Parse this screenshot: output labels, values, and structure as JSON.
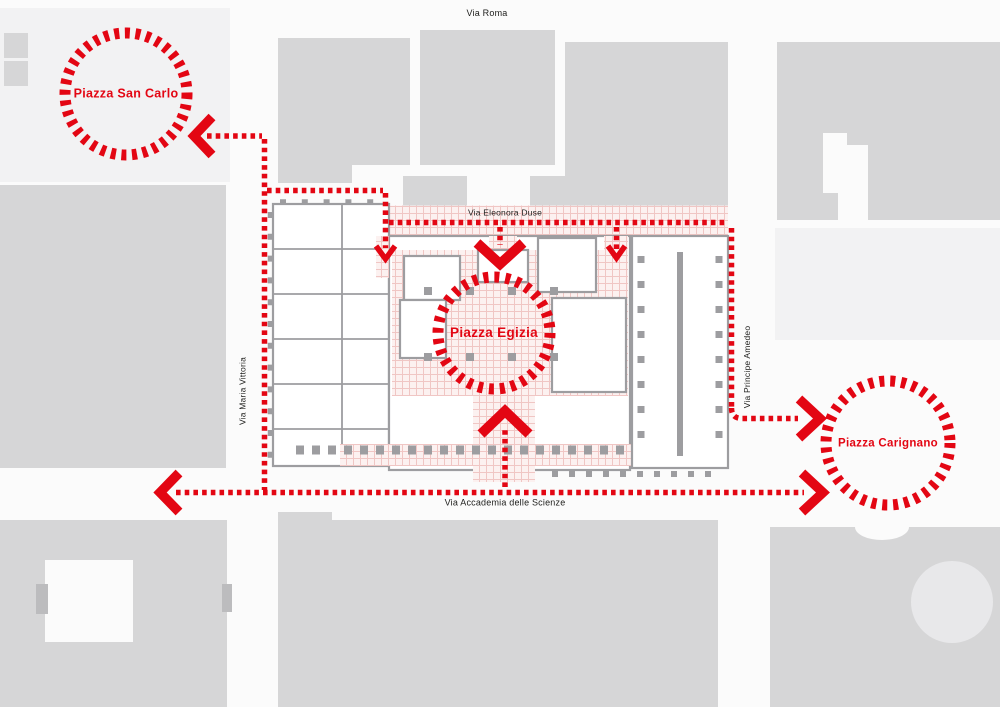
{
  "map": {
    "streets": {
      "via_roma": "Via Roma",
      "via_eleonora_duse": "Via Eleonora Duse",
      "via_maria_vittoria": "Via Maria Vittoria",
      "via_principe_amedeo": "Via Principe Amedeo",
      "via_accademia_delle_scienze": "Via Accademia delle Scienze"
    },
    "piazzas": {
      "san_carlo": "Piazza San Carlo",
      "egizia": "Piazza Egizia",
      "carignano": "Piazza Carignano"
    },
    "colors": {
      "flow_red": "#e30613",
      "piazza_label_red": "#e30613",
      "street_label_black": "#1d1d1b",
      "city_block_gray": "#d6d6d7",
      "light_block_gray": "#f2f2f3",
      "building_wall_gray": "#9d9da0",
      "paving_line_pink": "#f0c6c4",
      "paving_bg_pink": "#fcf1f0",
      "background": "#fbfbfb"
    }
  }
}
